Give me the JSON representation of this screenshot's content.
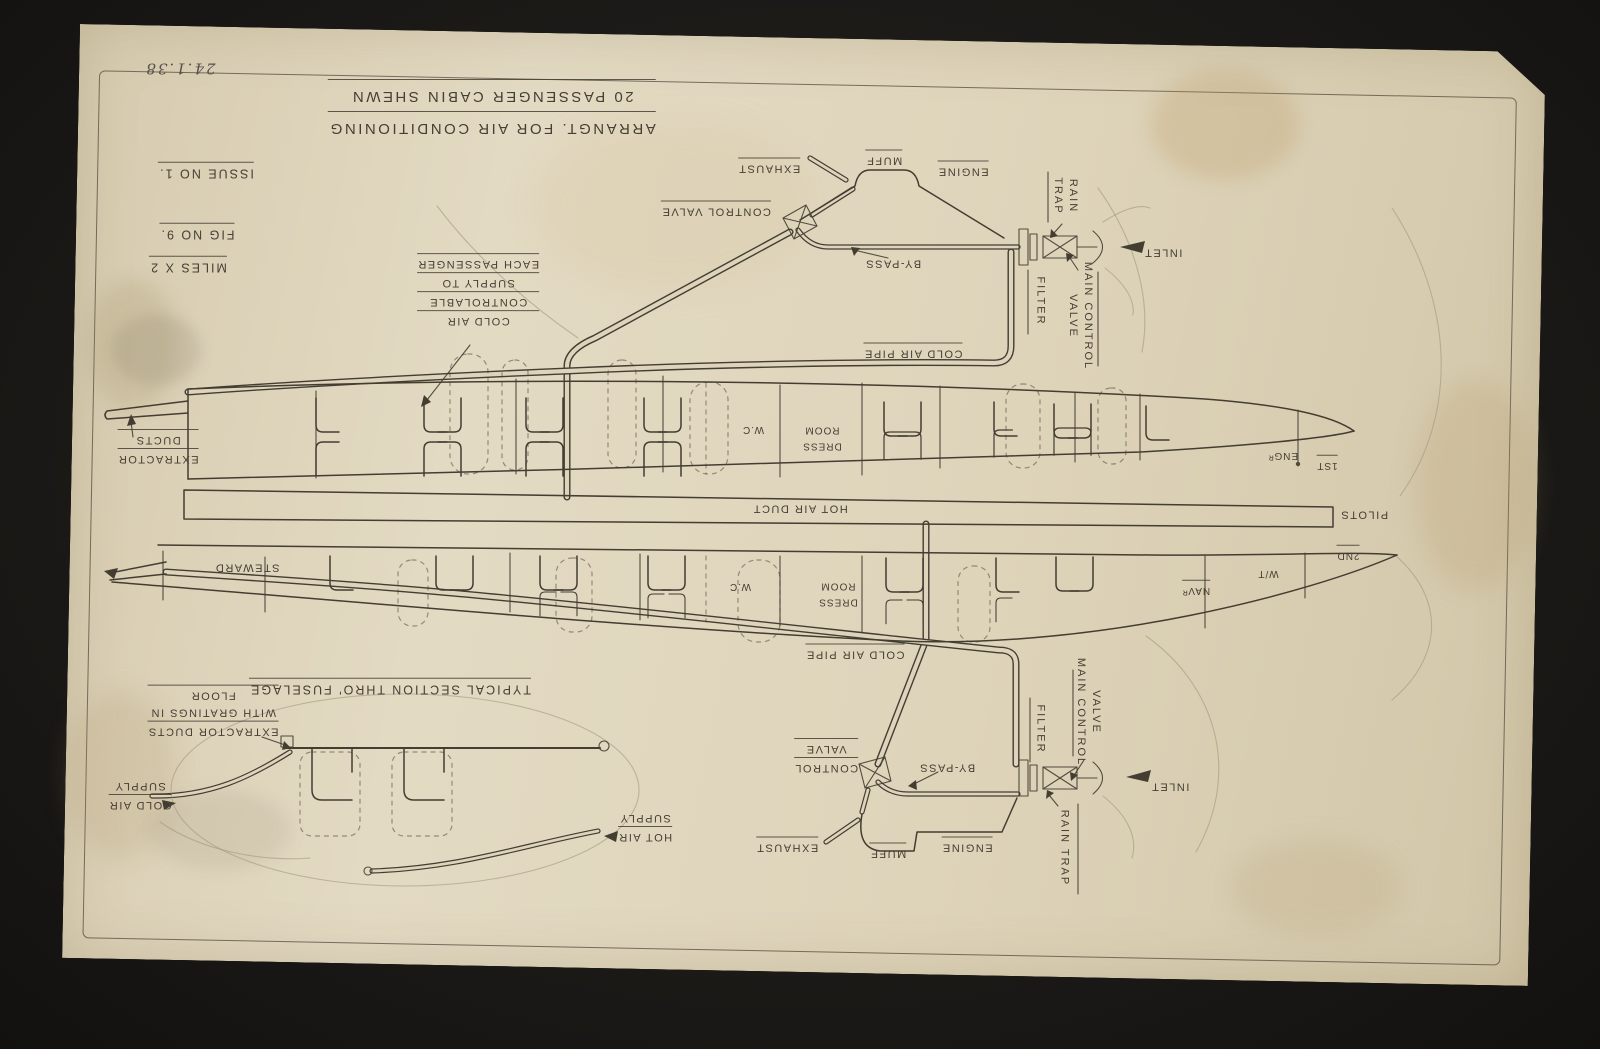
{
  "photo": {
    "date_note": "24.1.38"
  },
  "title_block": {
    "title_line1": "ARRANGT. FOR AIR CONDITIONING",
    "title_line2": "20 PASSENGER CABIN SHEWN",
    "issue_no": "ISSUE NO 1.",
    "fig_no": "FIG NO 9.",
    "scale_note": "MILES X 2"
  },
  "engine_top": {
    "exhaust": "EXHAUST",
    "muff": "MUFF",
    "engine": "ENGINE",
    "control_valve": "CONTROL VALVE",
    "by_pass": "BY-PASS",
    "rain_trap_word1": "RAIN",
    "rain_trap_word2": "TRAP",
    "filter": "FILTER",
    "main_control_line1": "MAIN CONTROL",
    "main_control_line2": "VALVE",
    "inlet": "INLET",
    "cold_air_pipe": "COLD AIR PIPE"
  },
  "cabin": {
    "cold_air_note": {
      "l1": "COLD AIR",
      "l2": "CONTROLABLE",
      "l3": "SUPPLY TO",
      "l4": "EACH PASSENGER"
    },
    "extractor": {
      "l1": "EXTRACTOR",
      "l2": "DUCTS"
    },
    "dress_room": {
      "l1": "DRESS",
      "l2": "ROOM"
    },
    "wc": "W.C",
    "hot_air_duct": "HOT AIR DUCT",
    "pilots": "PILOTS",
    "engineer": "ENGᴿ",
    "first_officer": "1ST",
    "second_officer": "2ND",
    "wireless": "W/T",
    "navigator": "NAVᴿ",
    "steward": "STEWARD",
    "cold_air_pipe": "COLD AIR PIPE"
  },
  "engine_bottom": {
    "control_valve": {
      "l1": "CONTROL",
      "l2": "VALVE"
    },
    "by_pass": "BY-PASS",
    "exhaust": "EXHAUST",
    "muff": "MUFF",
    "engine": "ENGINE",
    "filter": "FILTER",
    "main_control_line1": "MAIN CONTROL",
    "main_control_line2": "VALVE",
    "rain_trap": "RAIN TRAP",
    "inlet": "INLET"
  },
  "section": {
    "caption": "TYPICAL SECTION THRO' FUSELAGE",
    "extractor_note": {
      "l1": "EXTRACTOR DUCTS",
      "l2": "WITH GRATINGS IN",
      "l3": "FLOOR"
    },
    "cold_air": {
      "l1": "COLD AIR",
      "l2": "SUPPLY"
    },
    "hot_air": {
      "l1": "HOT AIR",
      "l2": "SUPPLY"
    }
  }
}
